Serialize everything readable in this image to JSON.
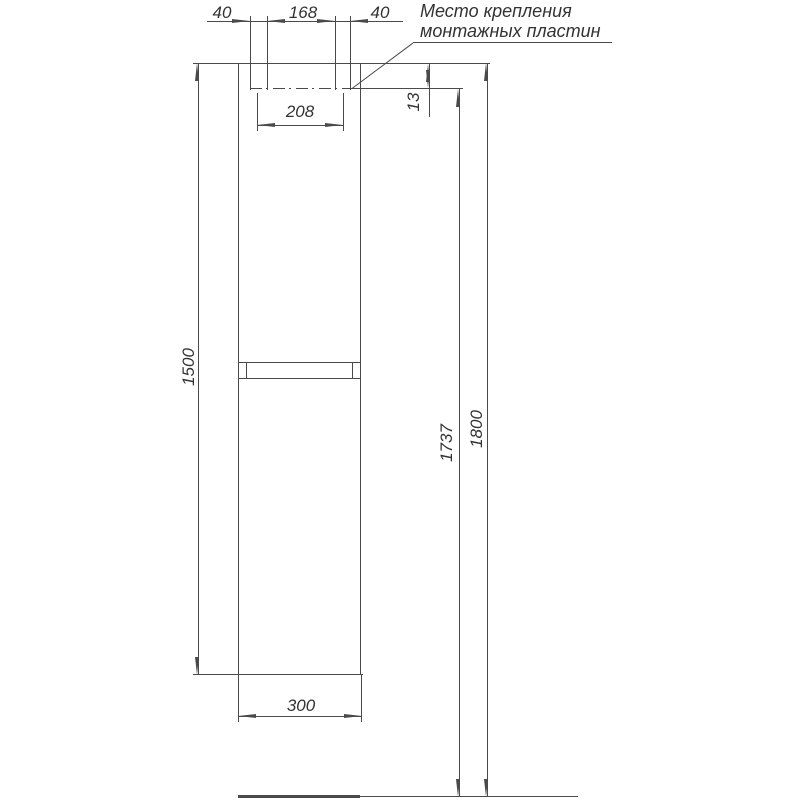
{
  "annotation": {
    "line1": "Место крепления",
    "line2": "монтажных пластин"
  },
  "dimensions": {
    "plate_left_width": "40",
    "plates_gap": "168",
    "plate_right_width": "40",
    "plates_center_span": "208",
    "plate_top_offset": "13",
    "body_height": "1500",
    "mount_height": "1737",
    "total_height": "1800",
    "cabinet_width": "300"
  },
  "colors": {
    "line": "#4a4a4a",
    "text": "#333333",
    "background": "#ffffff"
  }
}
